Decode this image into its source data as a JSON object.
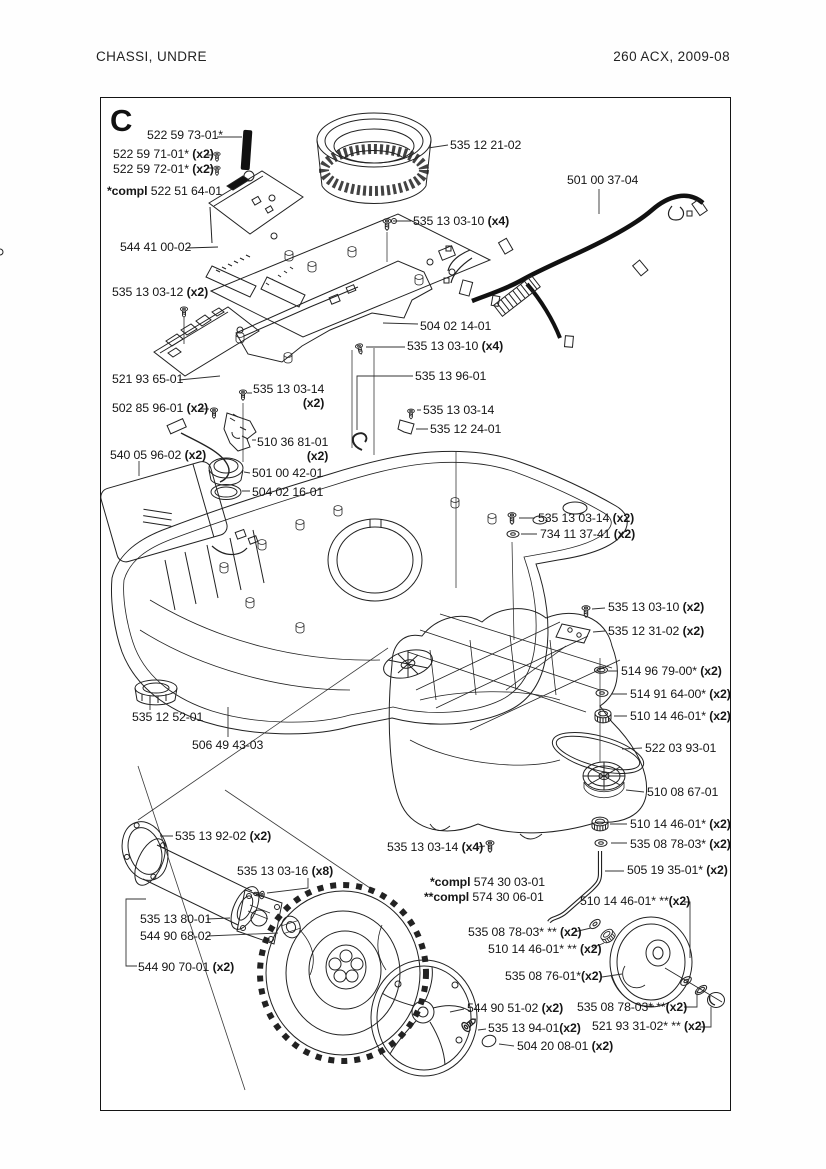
{
  "page": {
    "header_left": "CHASSI,  UNDRE",
    "header_right": "260 ACX, 2009-08",
    "section_letter": "C"
  },
  "labels": [
    {
      "num": "522 59 73-01*",
      "x": 147,
      "y": 129
    },
    {
      "num": "522 59 71-01*",
      "qty": "(x2)",
      "x": 113,
      "y": 148
    },
    {
      "num": "522 59 72-01*",
      "qty": "(x2)",
      "x": 113,
      "y": 163
    },
    {
      "prefix": "*compl ",
      "num": "522 51 64-01",
      "x": 107,
      "y": 185
    },
    {
      "num": "535 12 21-02",
      "x": 450,
      "y": 139
    },
    {
      "num": "501 00 37-04",
      "x": 567,
      "y": 174
    },
    {
      "num": "535 13 03-10",
      "qty": "(x4)",
      "x": 413,
      "y": 215
    },
    {
      "num": "544 41 00-02",
      "x": 120,
      "y": 241
    },
    {
      "num": "535 13 03-12",
      "qty": "(x2)",
      "x": 112,
      "y": 286
    },
    {
      "num": "504 02 14-01",
      "x": 420,
      "y": 320
    },
    {
      "num": "535 13 03-10",
      "qty": "(x4)",
      "x": 407,
      "y": 340
    },
    {
      "num": "535 13 96-01",
      "x": 415,
      "y": 370
    },
    {
      "num": "521 93 65-01",
      "x": 112,
      "y": 373
    },
    {
      "num": "535 13 03-14",
      "qty": "(x2)",
      "stack": true,
      "x": 253,
      "y": 383
    },
    {
      "num": "502 85 96-01",
      "qty": "(x2)",
      "x": 112,
      "y": 402
    },
    {
      "num": "535 13 03-14",
      "x": 423,
      "y": 404
    },
    {
      "num": "535 12 24-01",
      "x": 430,
      "y": 423
    },
    {
      "num": "510 36 81-01",
      "qty": "(x2)",
      "stack": true,
      "x": 257,
      "y": 436
    },
    {
      "num": "540 05 96-02",
      "qty": "(x2)",
      "x": 110,
      "y": 449
    },
    {
      "num": "501 00 42-01",
      "x": 252,
      "y": 467
    },
    {
      "num": "504 02 16-01",
      "x": 252,
      "y": 486
    },
    {
      "num": "535 13 03-14",
      "qty": "(x2)",
      "x": 538,
      "y": 512
    },
    {
      "num": "734 11 37-41",
      "qty": "(x2)",
      "x": 540,
      "y": 528
    },
    {
      "num": "535 13 03-10",
      "qty": "(x2)",
      "x": 608,
      "y": 601
    },
    {
      "num": "535 12 31-02",
      "qty": "(x2)",
      "x": 608,
      "y": 625
    },
    {
      "num": "514 96 79-00*",
      "qty": "(x2)",
      "x": 621,
      "y": 665
    },
    {
      "num": "514 91 64-00*",
      "qty": "(x2)",
      "x": 630,
      "y": 688
    },
    {
      "num": "510 14 46-01*",
      "qty": "(x2)",
      "x": 630,
      "y": 710
    },
    {
      "num": "522 03 93-01",
      "x": 645,
      "y": 742
    },
    {
      "num": "510 08 67-01",
      "x": 647,
      "y": 786
    },
    {
      "num": "535 12 52-01",
      "x": 132,
      "y": 711
    },
    {
      "num": "506 49 43-03",
      "x": 192,
      "y": 739
    },
    {
      "num": "510 14 46-01*",
      "qty": "(x2)",
      "x": 630,
      "y": 818
    },
    {
      "num": "535 08 78-03*",
      "qty": "(x2)",
      "x": 630,
      "y": 838
    },
    {
      "num": "535 13 92-02",
      "qty": "(x2)",
      "x": 175,
      "y": 830
    },
    {
      "num": "535 13 03-14",
      "qty": "(x4)",
      "x": 387,
      "y": 841
    },
    {
      "num": "505 19 35-01*",
      "qty": "(x2)",
      "x": 627,
      "y": 864
    },
    {
      "prefix": "*compl ",
      "num": "574 30 03-01",
      "x": 430,
      "y": 876
    },
    {
      "prefix": "**compl ",
      "num": "574 30 06-01",
      "x": 424,
      "y": 891
    },
    {
      "num": "535 13 03-16",
      "qty": "(x8)",
      "x": 237,
      "y": 865
    },
    {
      "num": "510 14 46-01* **",
      "qty": "(x2)",
      "nospace": true,
      "x": 580,
      "y": 895
    },
    {
      "num": "535 13 80-01",
      "x": 140,
      "y": 913
    },
    {
      "num": "544 90 68-02",
      "x": 140,
      "y": 930
    },
    {
      "num": "535 08 78-03* **",
      "qty": "(x2)",
      "x": 468,
      "y": 926
    },
    {
      "num": "510 14 46-01* **",
      "qty": "(x2)",
      "x": 488,
      "y": 943
    },
    {
      "num": "544 90 70-01",
      "qty": "(x2)",
      "x": 138,
      "y": 961
    },
    {
      "num": "535 08 76-01*",
      "qty": "(x2)",
      "nospace": true,
      "x": 505,
      "y": 970
    },
    {
      "num": "544 90 51-02",
      "qty": "(x2)",
      "x": 467,
      "y": 1002
    },
    {
      "num": "535 08 78-03* **",
      "qty": "(x2)",
      "nospace": true,
      "x": 577,
      "y": 1001
    },
    {
      "num": "535 13 94-01",
      "qty": "(x2)",
      "nospace": true,
      "x": 488,
      "y": 1022
    },
    {
      "num": "521 93 31-02* **",
      "qty": "(x2)",
      "x": 592,
      "y": 1020
    },
    {
      "num": "504 20 08-01",
      "qty": "(x2)",
      "x": 517,
      "y": 1040
    }
  ]
}
